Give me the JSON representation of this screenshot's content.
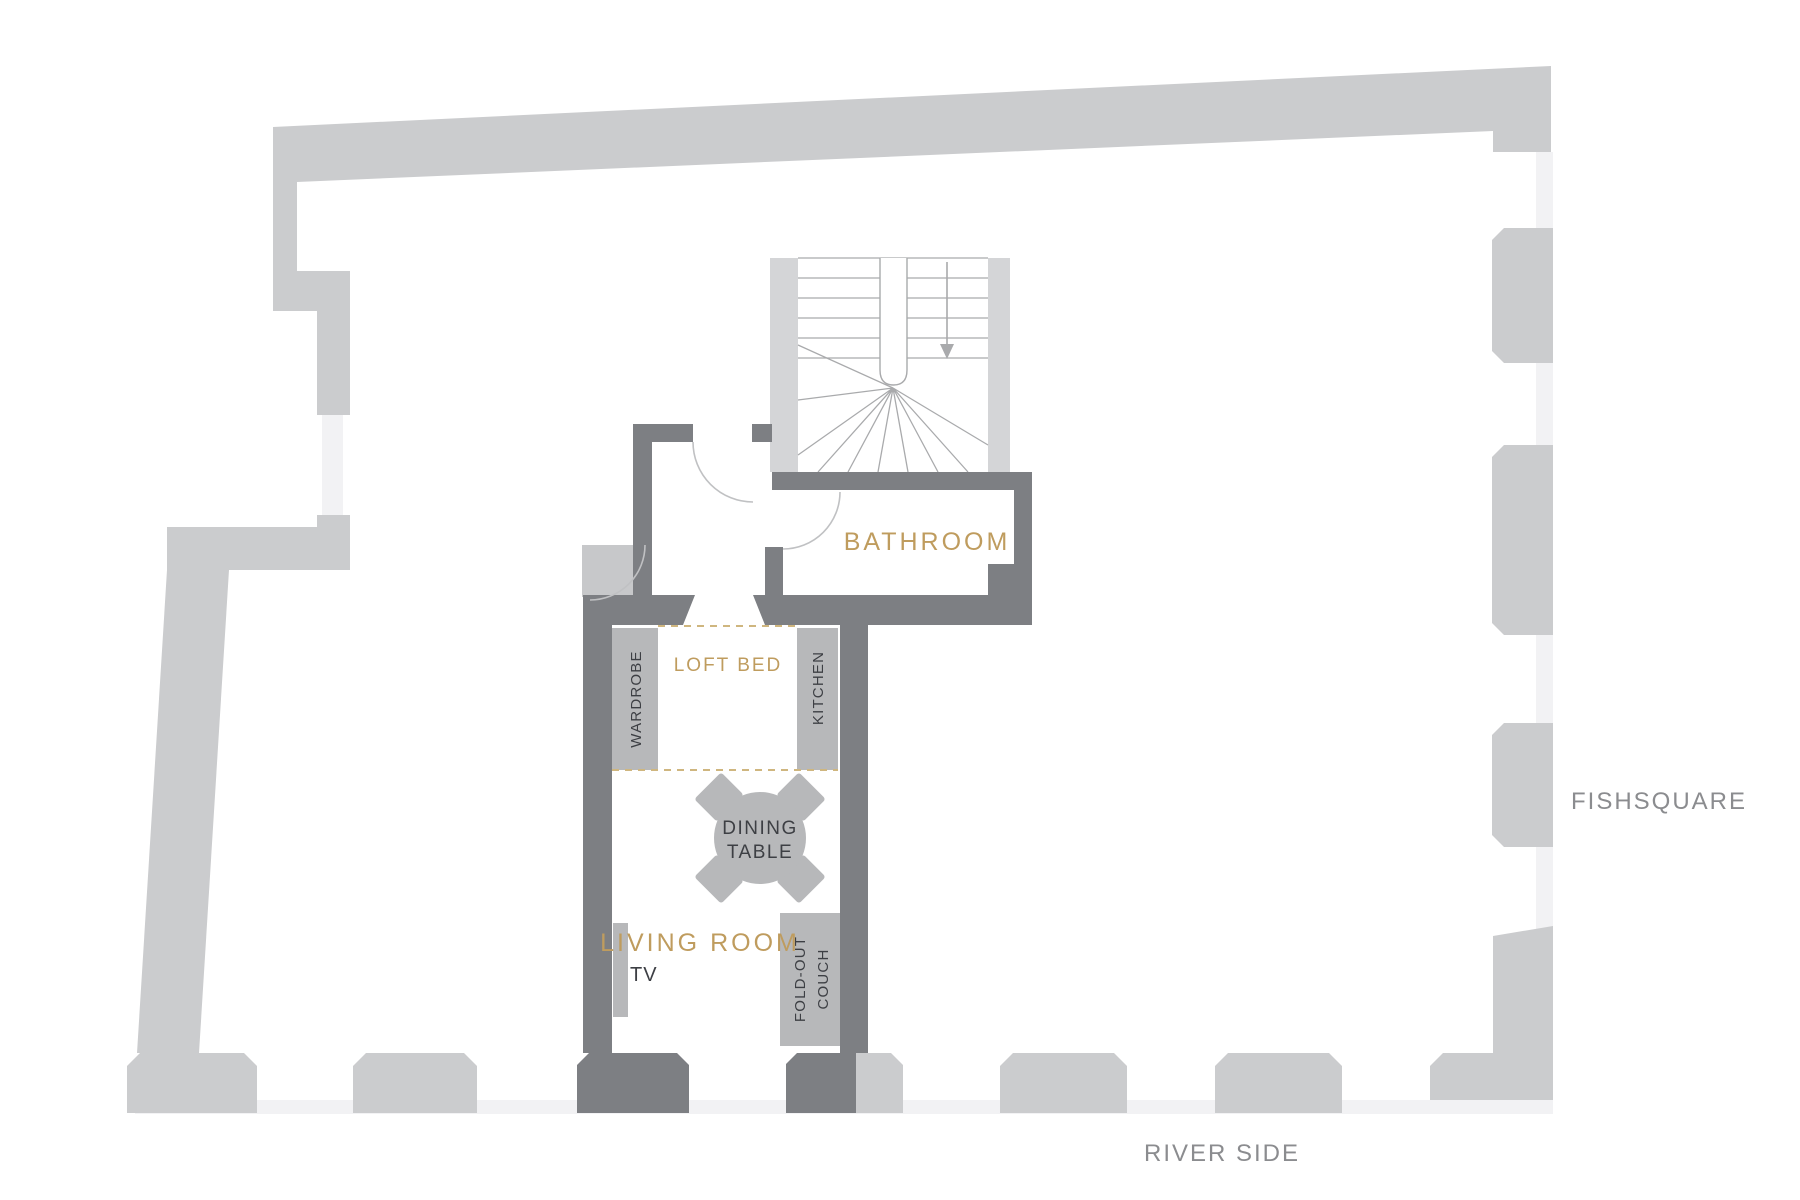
{
  "plan": {
    "rooms": {
      "bathroom": {
        "label": "BATHROOM"
      },
      "loft_bed": {
        "label": "LOFT BED"
      },
      "living_room": {
        "label": "LIVING ROOM"
      }
    },
    "furniture": {
      "wardrobe": {
        "label": "WARDROBE"
      },
      "kitchen": {
        "label": "KITCHEN"
      },
      "dining_table": {
        "label_line1": "DINING",
        "label_line2": "TABLE"
      },
      "tv": {
        "label": "TV"
      },
      "fold_out_couch": {
        "label_line1": "FOLD-OUT",
        "label_line2": "COUCH"
      }
    },
    "streets": {
      "right": {
        "label": "FISHSQUARE"
      },
      "bottom": {
        "label": "RIVER SIDE"
      }
    },
    "stairs": {
      "arrow_direction": "down"
    },
    "colors": {
      "outer_wall": "#cbccce",
      "inner_wall": "#7d7f83",
      "furniture": "#b7b8ba",
      "light_block": "#c7c8ca",
      "stair_strip": "#d4d5d7",
      "window": "#f2f2f4",
      "stair_line": "#a9aaac",
      "door_arc": "#c0c1c3",
      "accent_gold": "#bf9c5e",
      "dashed_gold": "#cfb67f",
      "dark_text": "#3d3f44",
      "street_text": "#8b8c8f"
    }
  }
}
